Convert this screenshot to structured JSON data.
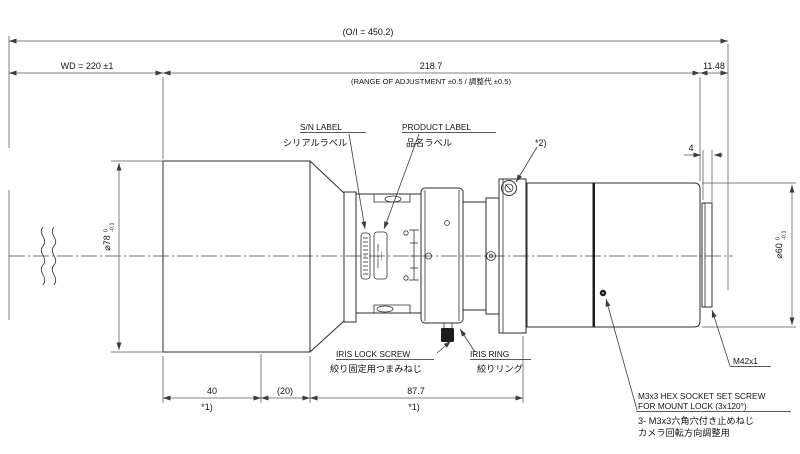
{
  "drawing": {
    "dims": {
      "oi": "(O/I = 450.2)",
      "wd": "WD = 220 ±1",
      "adjust_len": "218.7",
      "adjust_note": "(RANGE OF ADJUSTMENT ±0.5 / 調整代 ±0.5)",
      "ffd": "11.48",
      "thread_len": "4",
      "front_len": "40",
      "hood_len": "(20)",
      "body_len": "87.7",
      "footnote1": "*1)",
      "footnote2": "*2)",
      "front_dia": "⌀78",
      "front_dia_tol_upper": "0",
      "front_dia_tol_lower": "-0.1",
      "rear_dia": "⌀60",
      "rear_dia_tol_upper": "0",
      "rear_dia_tol_lower": "-0.1"
    },
    "callouts": {
      "sn_label_en": "S/N LABEL",
      "sn_label_jp": "シリアルラベル",
      "product_label_en": "PRODUCT LABEL",
      "product_label_jp": "品名ラベル",
      "iris_lock_en": "IRIS LOCK SCREW",
      "iris_lock_jp": "絞り固定用つまみねじ",
      "iris_ring_en": "IRIS RING",
      "iris_ring_jp": "絞りリング",
      "mount_thread": "M42x1",
      "set_screw_l1": "M3x3 HEX SOCKET SET SCREW",
      "set_screw_l2": "FOR MOUNT LOCK (3x120°)",
      "set_screw_l3": "3- M3x3六角穴付き止めねじ",
      "set_screw_l4": "カメラ回転方向調整用"
    },
    "micro": {
      "product_label_line1": "PRODUCT NAME",
      "product_label_line2": "********"
    }
  }
}
